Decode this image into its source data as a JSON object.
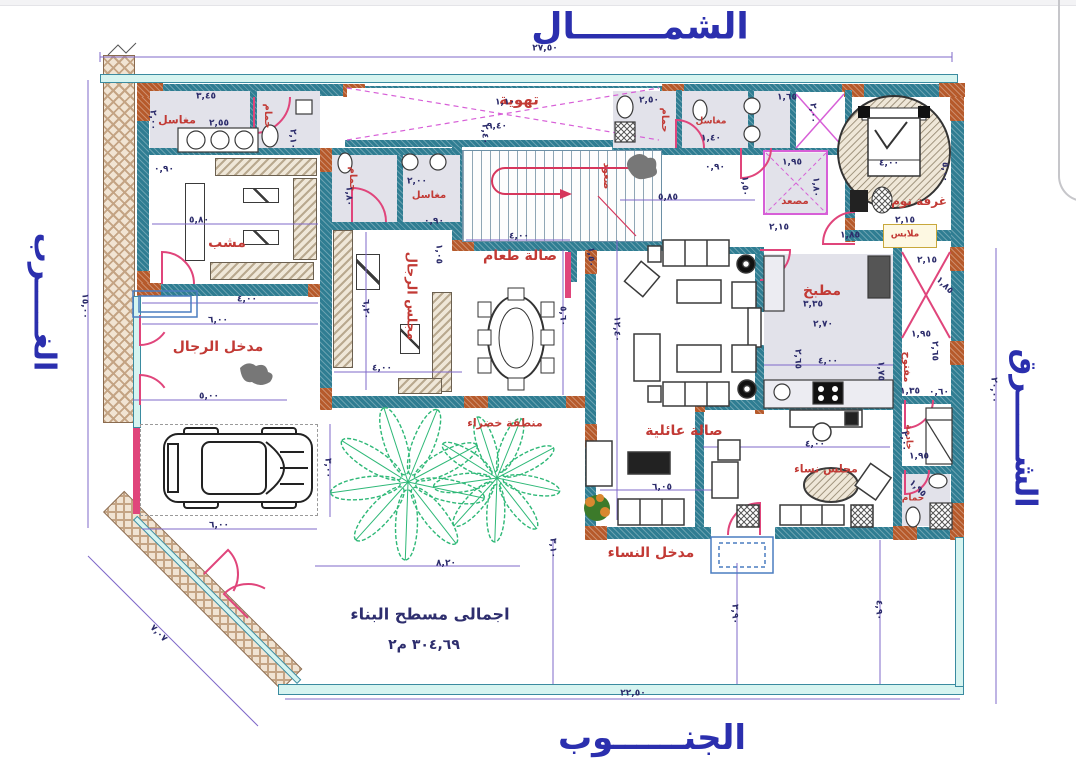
{
  "compass": {
    "north": "الشمـــــــال",
    "south": "الجنــــــوب",
    "west": "الغـــــرب",
    "east": "الشــــــرق"
  },
  "plot_dimensions": {
    "top": "٢٧,٥٠",
    "bottom": "٢٢,٥٠",
    "left": "١٥,٠٠",
    "right": "٢٠,٠٠",
    "diagonal": "٧,٠٧"
  },
  "area_note": {
    "line1": "اجمالى مسطح البناء",
    "line2": "٣٠٤,٦٩ م٢"
  },
  "rooms": [
    {
      "id": "ventilation",
      "label": "تهوية",
      "x": 519,
      "y": 100,
      "s": 15
    },
    {
      "id": "sinks-1",
      "label": "مغاسل",
      "x": 177,
      "y": 120,
      "s": 11
    },
    {
      "id": "bath-1",
      "label": "حمام",
      "x": 267,
      "y": 116,
      "s": 10,
      "r": 90
    },
    {
      "id": "mashab",
      "label": "مشب",
      "x": 227,
      "y": 243,
      "s": 14
    },
    {
      "id": "bath-2",
      "label": "حمام",
      "x": 352,
      "y": 179,
      "s": 10,
      "r": 90
    },
    {
      "id": "sinks-2",
      "label": "مغاسل",
      "x": 429,
      "y": 196,
      "s": 10
    },
    {
      "id": "stairs-up",
      "label": "صعود",
      "x": 606,
      "y": 176,
      "s": 10,
      "r": 90
    },
    {
      "id": "bath-3",
      "label": "حمام",
      "x": 664,
      "y": 120,
      "s": 10,
      "r": 90
    },
    {
      "id": "sinks-3",
      "label": "مغاسل",
      "x": 711,
      "y": 122,
      "s": 9
    },
    {
      "id": "elevator",
      "label": "مصعد",
      "x": 795,
      "y": 202,
      "s": 10
    },
    {
      "id": "bedroom",
      "label": "غرفة نوم",
      "x": 919,
      "y": 201,
      "s": 12
    },
    {
      "id": "closet",
      "label": "ملابس",
      "x": 905,
      "y": 235,
      "s": 9
    },
    {
      "id": "kitchen",
      "label": "مطبخ",
      "x": 822,
      "y": 291,
      "s": 14
    },
    {
      "id": "open-shaft",
      "label": "مفتوح",
      "x": 906,
      "y": 367,
      "s": 10,
      "r": 90
    },
    {
      "id": "maid",
      "label": "خادمة",
      "x": 908,
      "y": 437,
      "s": 9,
      "r": 90
    },
    {
      "id": "bath-4",
      "label": "حمام",
      "x": 913,
      "y": 499,
      "s": 9
    },
    {
      "id": "mens-majlis",
      "label": "مجلس الرجال",
      "x": 411,
      "y": 296,
      "s": 13,
      "r": 90
    },
    {
      "id": "dining-hall",
      "label": "صالة طعام",
      "x": 520,
      "y": 256,
      "s": 14
    },
    {
      "id": "family-hall",
      "label": "صالة عائلية",
      "x": 684,
      "y": 431,
      "s": 14
    },
    {
      "id": "womens-majlis",
      "label": "مجلس نساء",
      "x": 826,
      "y": 469,
      "s": 11
    },
    {
      "id": "green-area",
      "label": "منطقة خضراء",
      "x": 505,
      "y": 423,
      "s": 11
    },
    {
      "id": "mens-entrance",
      "label": "مدخل الرجال",
      "x": 218,
      "y": 347,
      "s": 14
    },
    {
      "id": "womens-entrance",
      "label": "مدخل النساء",
      "x": 651,
      "y": 553,
      "s": 14
    }
  ],
  "dims": [
    {
      "t": "٢٧,٥٠",
      "x": 545,
      "y": 49
    },
    {
      "t": "١٥,٠٠",
      "x": 84,
      "y": 306,
      "r": 90
    },
    {
      "t": "٢٠,٠٠",
      "x": 993,
      "y": 390,
      "r": 90
    },
    {
      "t": "٢٢,٥٠",
      "x": 633,
      "y": 694
    },
    {
      "t": "٧,٠٧",
      "x": 158,
      "y": 634,
      "r": 45
    },
    {
      "t": "٣,٤٥",
      "x": 206,
      "y": 97
    },
    {
      "t": "٢,٥٥",
      "x": 219,
      "y": 124
    },
    {
      "t": "٢,٠٠",
      "x": 152,
      "y": 120,
      "r": 90
    },
    {
      "t": "٠,٩٠",
      "x": 164,
      "y": 170
    },
    {
      "t": "٥,٨٠",
      "x": 199,
      "y": 221
    },
    {
      "t": "٢,١٠",
      "x": 292,
      "y": 139,
      "r": 90
    },
    {
      "t": "٩,٤٠",
      "x": 497,
      "y": 127
    },
    {
      "t": "١,١٠",
      "x": 505,
      "y": 103
    },
    {
      "t": "٢,٤٠",
      "x": 484,
      "y": 134,
      "r": 90
    },
    {
      "t": "٢,٥٠",
      "x": 649,
      "y": 101
    },
    {
      "t": "١,٤٠",
      "x": 711,
      "y": 139
    },
    {
      "t": "١,٦٥",
      "x": 787,
      "y": 98
    },
    {
      "t": "٢,٠٠",
      "x": 812,
      "y": 113,
      "r": 90
    },
    {
      "t": "١,٨٠",
      "x": 348,
      "y": 196,
      "r": 90
    },
    {
      "t": "٢,٠٠",
      "x": 417,
      "y": 182
    },
    {
      "t": "٠,٩٠",
      "x": 434,
      "y": 222
    },
    {
      "t": "١,٩٥",
      "x": 792,
      "y": 163
    },
    {
      "t": "١,٨٠",
      "x": 815,
      "y": 187,
      "r": 90
    },
    {
      "t": "٠,٩٠",
      "x": 715,
      "y": 168
    },
    {
      "t": "١,٥٠",
      "x": 744,
      "y": 186,
      "r": 90
    },
    {
      "t": "٥,٨٥",
      "x": 668,
      "y": 198
    },
    {
      "t": "٤,٠٠",
      "x": 889,
      "y": 164
    },
    {
      "t": "٥,٠٠",
      "x": 944,
      "y": 172,
      "r": 90
    },
    {
      "t": "٢,١٥",
      "x": 905,
      "y": 221
    },
    {
      "t": "١,٨٥",
      "x": 850,
      "y": 236
    },
    {
      "t": "٢,١٥",
      "x": 779,
      "y": 228
    },
    {
      "t": "٤,٠٠",
      "x": 247,
      "y": 300
    },
    {
      "t": "٦,٠٠",
      "x": 218,
      "y": 321
    },
    {
      "t": "٥,٠٠",
      "x": 209,
      "y": 397
    },
    {
      "t": "٦,٢٠",
      "x": 365,
      "y": 309,
      "r": 90
    },
    {
      "t": "١,٠٥",
      "x": 438,
      "y": 254,
      "r": 90
    },
    {
      "t": "٤,٠٠",
      "x": 382,
      "y": 369
    },
    {
      "t": "٤,٠٠",
      "x": 519,
      "y": 237
    },
    {
      "t": "١,٥٠",
      "x": 590,
      "y": 257,
      "r": 90
    },
    {
      "t": "٥,٦٠",
      "x": 562,
      "y": 316,
      "r": 90
    },
    {
      "t": "١٢,٤٠",
      "x": 616,
      "y": 329,
      "r": 90
    },
    {
      "t": "٣,٣٥",
      "x": 813,
      "y": 305
    },
    {
      "t": "٢,٧٠",
      "x": 823,
      "y": 325
    },
    {
      "t": "٤,٠٠",
      "x": 828,
      "y": 362
    },
    {
      "t": "٢,٦٥",
      "x": 797,
      "y": 359,
      "r": 90
    },
    {
      "t": "١,٧٥",
      "x": 880,
      "y": 371,
      "r": 90
    },
    {
      "t": "٢,١٥",
      "x": 927,
      "y": 261
    },
    {
      "t": "١,٨٥",
      "x": 944,
      "y": 286,
      "r": 45
    },
    {
      "t": "١,٩٥",
      "x": 921,
      "y": 335
    },
    {
      "t": "٢,٦٥",
      "x": 934,
      "y": 351,
      "r": 90
    },
    {
      "t": "١,٣٥",
      "x": 910,
      "y": 392
    },
    {
      "t": "٠,٦٠",
      "x": 939,
      "y": 393
    },
    {
      "t": "٢,٠٠",
      "x": 903,
      "y": 441,
      "r": 90
    },
    {
      "t": "١,٩٥",
      "x": 919,
      "y": 457
    },
    {
      "t": "١,٩٥",
      "x": 917,
      "y": 489,
      "r": 45
    },
    {
      "t": "٦,٠٥",
      "x": 662,
      "y": 488
    },
    {
      "t": "٤,٠٠",
      "x": 815,
      "y": 445
    },
    {
      "t": "٣,٠٠",
      "x": 327,
      "y": 468,
      "r": 90
    },
    {
      "t": "٦,٠٠",
      "x": 219,
      "y": 526
    },
    {
      "t": "٨,٢٠",
      "x": 446,
      "y": 564
    },
    {
      "t": "٣,١٠",
      "x": 552,
      "y": 548,
      "r": 90
    },
    {
      "t": "٣,٩٠",
      "x": 734,
      "y": 614,
      "r": 90
    },
    {
      "t": "٤,٩٠",
      "x": 878,
      "y": 610,
      "r": 90
    }
  ],
  "colors": {
    "wall_teal": "#2f7d92",
    "wall_orange": "#b65a2b",
    "plot_cyan": "#d6f4f0",
    "dim_purple": "#7f68c9",
    "label_red": "#c23a35",
    "door_pink": "#e0457b",
    "shaft_magenta": "#d75fd7",
    "compass_blue": "#2b2fae",
    "palm_green": "#2eb877",
    "number_navy": "#2c2c6b"
  }
}
